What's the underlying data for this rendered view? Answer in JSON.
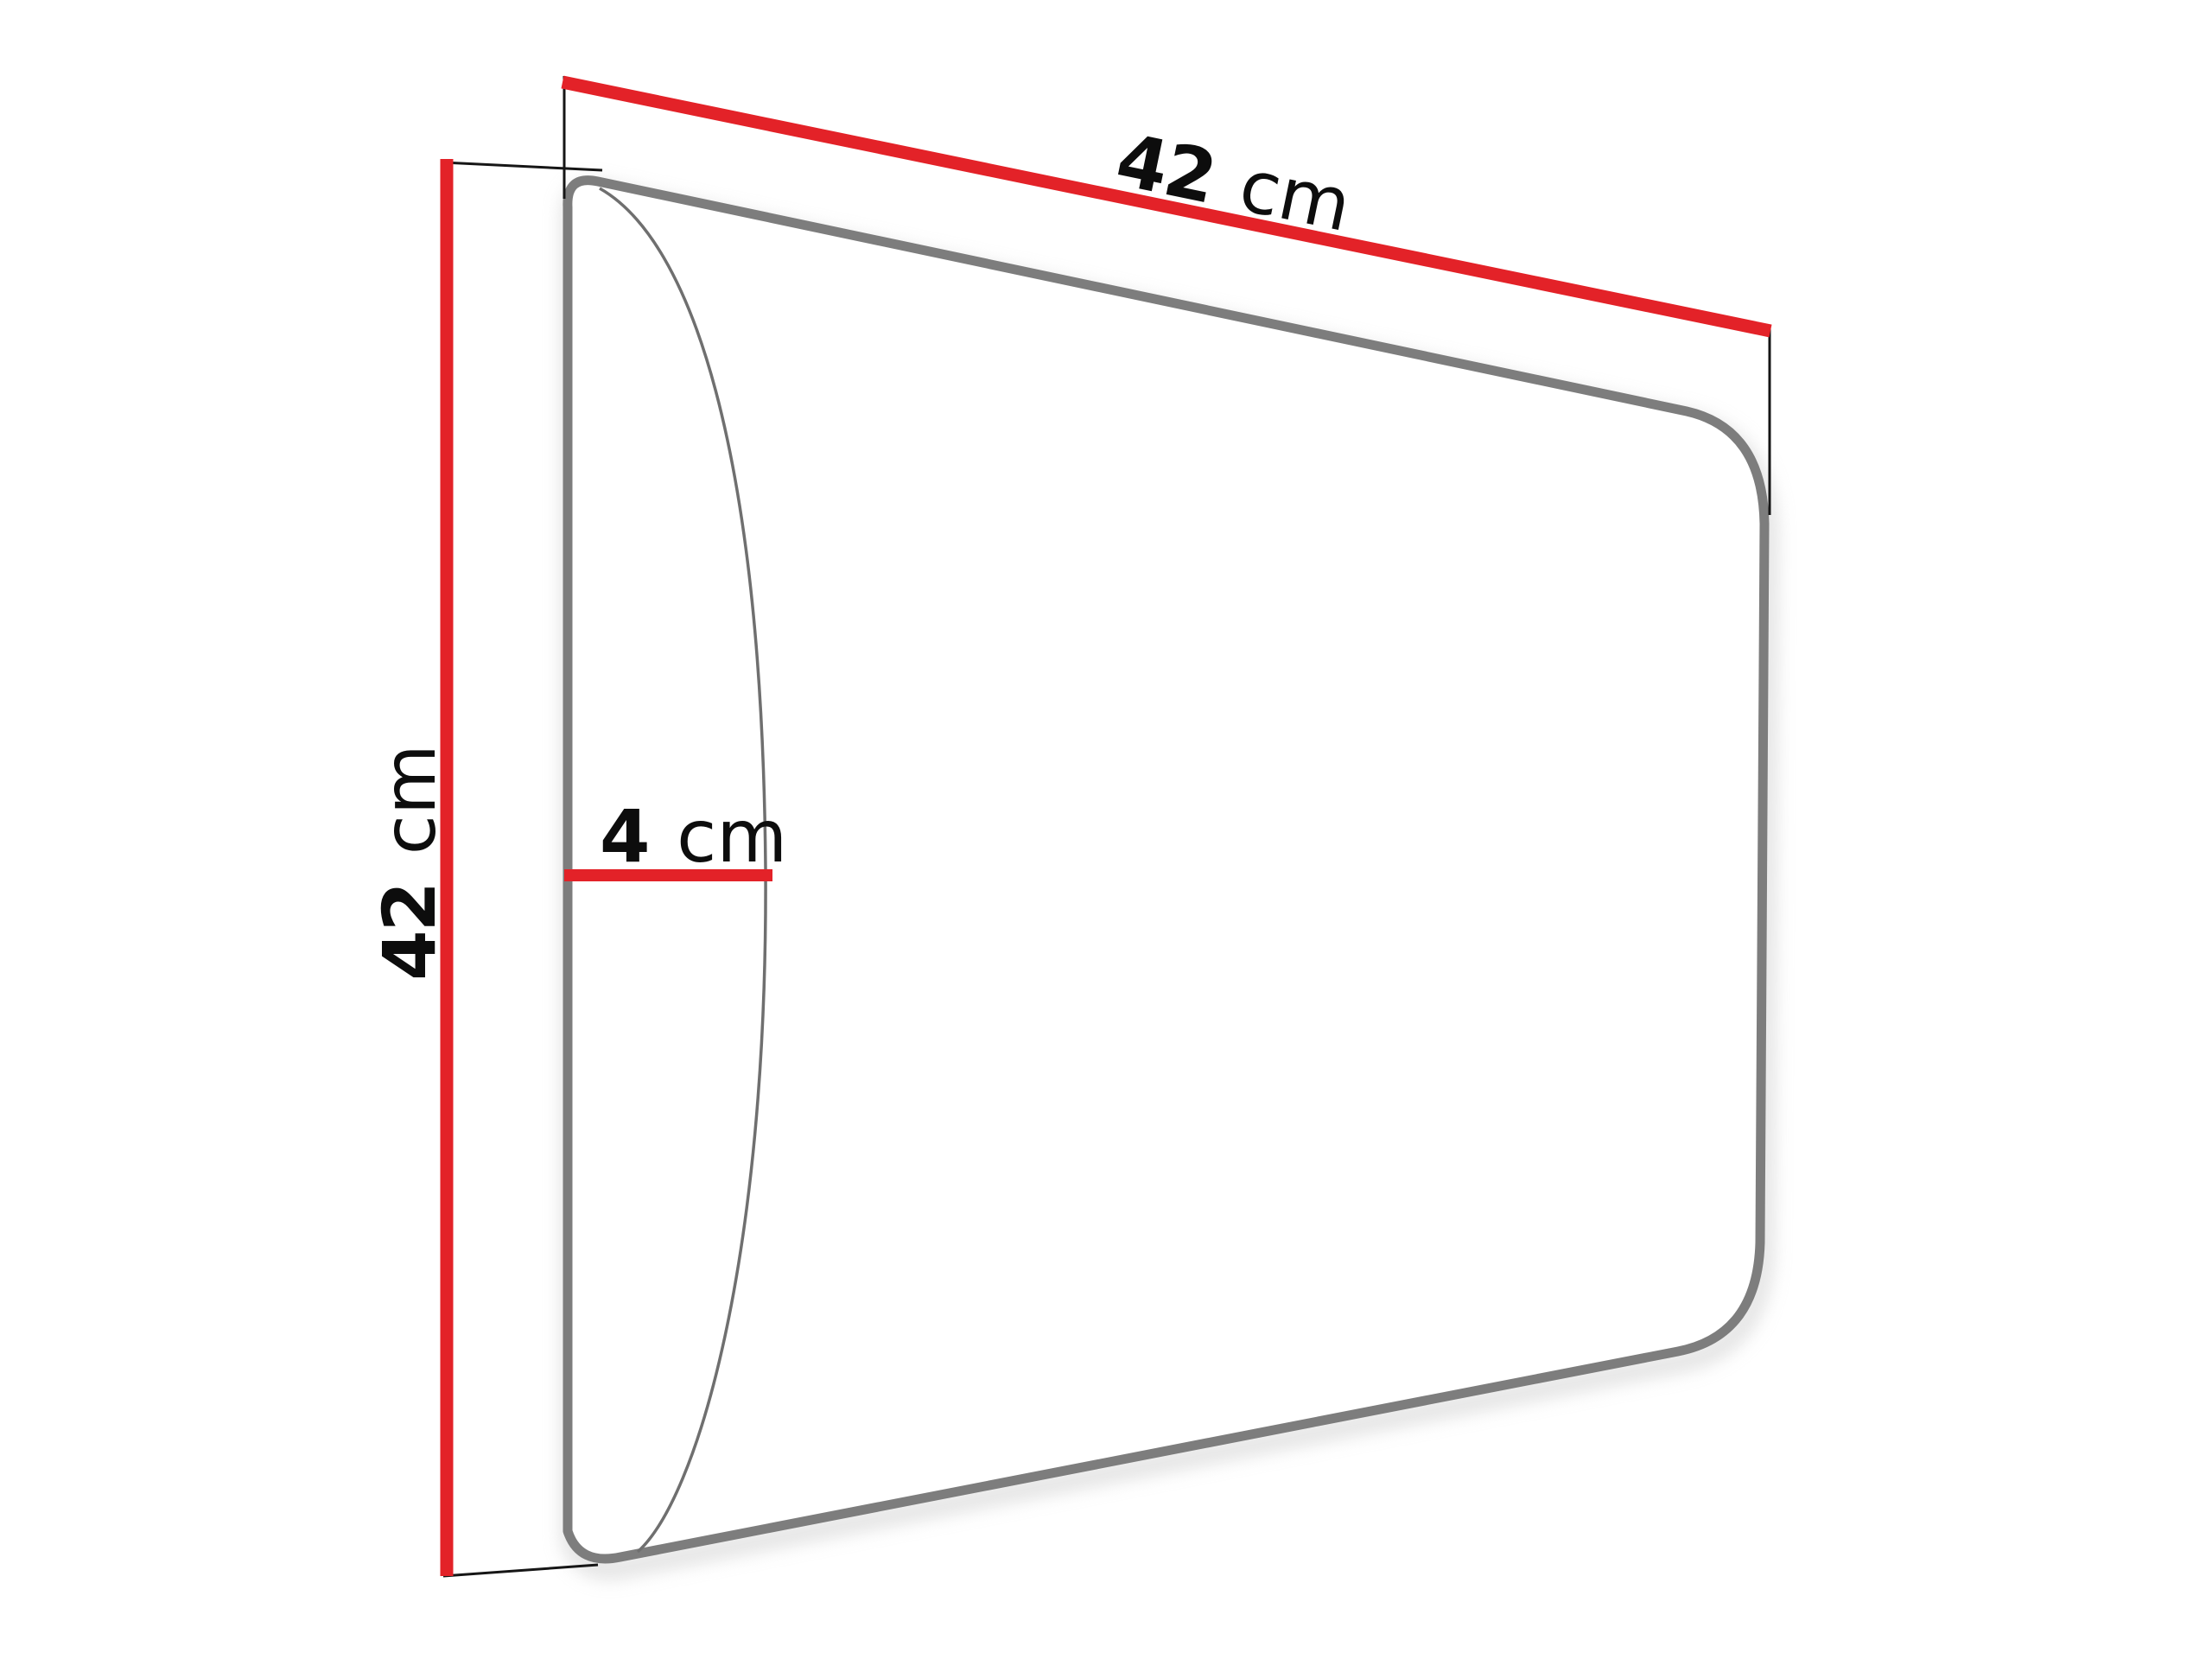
{
  "diagram": {
    "type": "product-dimension-drawing",
    "dimensions": {
      "width": {
        "value": "42",
        "unit": "cm"
      },
      "height": {
        "value": "42",
        "unit": "cm"
      },
      "depth": {
        "value": "4",
        "unit": "cm"
      }
    },
    "colors": {
      "dimension_line": "#e32228",
      "panel_outline": "#7d7d7d",
      "bulge_curve": "#6f6f6f",
      "extension_line": "#161616",
      "label_text": "#0d0d0d",
      "shadow": "#bdbdbd",
      "panel_fill": "#ffffff",
      "background": "#ffffff"
    }
  }
}
